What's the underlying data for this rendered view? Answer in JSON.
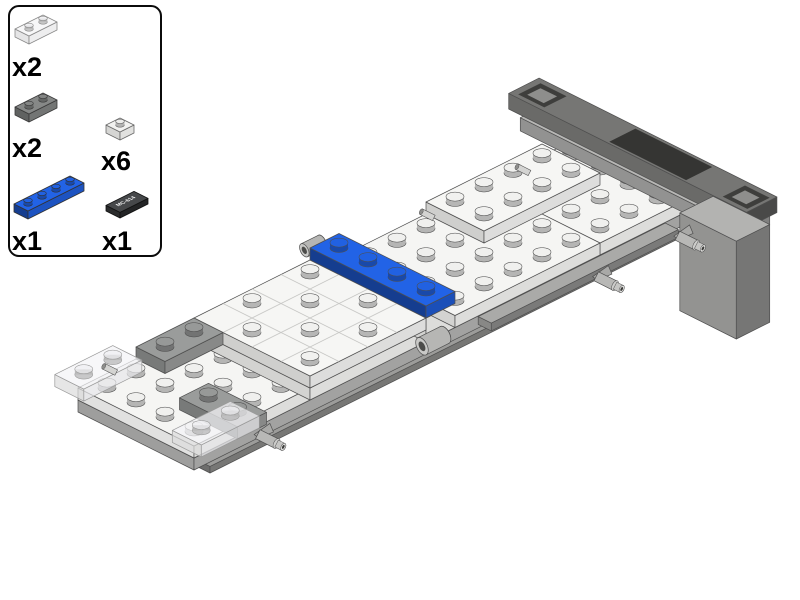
{
  "page": {
    "background": "#ffffff"
  },
  "parts_list": {
    "items": [
      {
        "part_name": "trans-clear plate 1x2",
        "count_label": "x2"
      },
      {
        "part_name": "dark gray plate 1x2",
        "count_label": "x2"
      },
      {
        "part_name": "white plate 1x1",
        "count_label": "x6"
      },
      {
        "part_name": "blue plate 1x4",
        "count_label": "x1"
      },
      {
        "part_name": "black license plate tile 1x2",
        "count_label": "x1",
        "print": "MC-614"
      }
    ]
  },
  "colors": {
    "white_plate": "#f5f5f3",
    "gray_base": "#c6c6c4",
    "medium_gray": "#9a9c9b",
    "dark_gray_bar": "#767674",
    "blue": "#2263e6",
    "trans_clear": "#f4f4f6",
    "black_tile": "#46484a",
    "outline": "#4f4f4f"
  },
  "render": {
    "groups": [
      {
        "name": "chassis-assembly",
        "proj": {
          "ox": 78,
          "oy": 400,
          "kx": 29,
          "ky": 14.5,
          "ph": 12,
          "line": "#4f4f4f",
          "lw": 0.7
        },
        "items": [
          {
            "t": "box",
            "name": "under-shadow",
            "u0": 0.4,
            "v0": 0.3,
            "u1": 16.6,
            "v1": 4.15,
            "h0": -1.55,
            "h1": -1,
            "c": "#9c9c9a",
            "fl": 0.7,
            "fr": 0.76
          },
          {
            "t": "box",
            "name": "gray-base-plate",
            "u0": 0,
            "v0": 0,
            "u1": 17,
            "v1": 4,
            "h0": -1,
            "h1": 0,
            "c": "#c6c6c4",
            "fl": 0.8,
            "fr": 0.82
          },
          {
            "t": "box",
            "name": "rear-white-plate",
            "u0": 14,
            "v0": 0,
            "u1": 17,
            "v1": 4,
            "h0": 0,
            "h1": 1,
            "c": "#f5f5f3",
            "fl": 0.86,
            "fr": 0.9,
            "studs": [
              [
                0.5,
                0.5
              ],
              [
                0.5,
                1.5
              ],
              [
                0.5,
                2.5
              ],
              [
                0.5,
                3.5
              ],
              [
                1.5,
                0.5
              ],
              [
                1.5,
                1.5
              ],
              [
                1.5,
                2.5
              ],
              [
                1.5,
                3.5
              ],
              [
                2.5,
                0.5
              ],
              [
                2.5,
                1.5
              ],
              [
                2.5,
                2.5
              ],
              [
                2.5,
                3.5
              ]
            ]
          },
          {
            "t": "box",
            "name": "bumper-under-beam",
            "u0": 16.45,
            "v0": -1.2,
            "u1": 17.5,
            "v1": 6.35,
            "h0": 1.1,
            "h1": 2.2,
            "c": "#b7b7b5",
            "fl": 0.8,
            "fr": 0.7
          },
          {
            "t": "box",
            "name": "rear-bumper-bar",
            "u0": 16.55,
            "v0": -1.7,
            "u1": 17.6,
            "v1": 6.5,
            "h0": 2.2,
            "h1": 3.5,
            "c": "#767674",
            "fl": 0.9,
            "fr": 0.62,
            "patches": [
              {
                "u0": 16.62,
                "v0": 1.7,
                "u1": 17.52,
                "v1": 4.35,
                "c": "#353533"
              },
              {
                "u0": 16.68,
                "v0": -1.5,
                "u1": 17.45,
                "v1": -0.6,
                "c": "#3e3e3c"
              },
              {
                "u0": 16.82,
                "v0": -1.33,
                "u1": 17.28,
                "v1": -0.76,
                "c": "#8e8e8c"
              },
              {
                "u0": 16.68,
                "v0": 5.55,
                "u1": 17.45,
                "v1": 6.4,
                "c": "#3e3e3c"
              },
              {
                "u0": 16.82,
                "v0": 5.72,
                "u1": 17.28,
                "v1": 6.22,
                "c": "#8e8e8c"
              }
            ]
          },
          {
            "t": "box",
            "name": "bumper-support-block",
            "u0": 16.35,
            "v0": 4.4,
            "u1": 17.5,
            "v1": 6.35,
            "h0": -7,
            "h1": 1.15,
            "c": "#b3b3b1",
            "fl": 0.82,
            "fr": 0.66
          },
          {
            "t": "box",
            "name": "side-rail-beam",
            "u0": 9.9,
            "v0": 3.9,
            "u1": 16.35,
            "v1": 4.35,
            "h0": -0.95,
            "h1": -0.3,
            "c": "#aaaaa8",
            "fl": 0.8,
            "fr": 0.72
          },
          {
            "t": "box",
            "name": "front-white-plate",
            "u0": 0,
            "v0": 0,
            "u1": 4,
            "v1": 4,
            "h0": 0,
            "h1": 1,
            "c": "#f5f5f3",
            "fl": 0.92,
            "fr": 0.9,
            "studs": [
              [
                0.5,
                0.5
              ],
              [
                0.5,
                1.5
              ],
              [
                0.5,
                2.5
              ],
              [
                0.5,
                3.5
              ],
              [
                1.5,
                0.5
              ],
              [
                1.5,
                1.5
              ],
              [
                1.5,
                2.5
              ],
              [
                1.5,
                3.5
              ],
              [
                2.5,
                0.5
              ],
              [
                2.5,
                1.5
              ],
              [
                2.5,
                2.5
              ],
              [
                2.5,
                3.5
              ],
              [
                3.5,
                0.5
              ],
              [
                3.5,
                1.5
              ],
              [
                3.5,
                2.5
              ],
              [
                3.5,
                3.5
              ]
            ]
          },
          {
            "t": "box",
            "name": "center-white-plate",
            "u0": 4,
            "v0": 0,
            "u1": 8,
            "v1": 4,
            "h0": 0,
            "h1": 1,
            "c": "#f5f5f3",
            "fl": 0.86,
            "fr": 0.9
          },
          {
            "t": "box",
            "name": "blue-under-plate",
            "u0": 8,
            "v0": 0,
            "u1": 9,
            "v1": 4,
            "h0": 0,
            "h1": 2,
            "c": "#f5f5f3",
            "fl": 0.86,
            "fr": 0.9
          },
          {
            "t": "box",
            "name": "mid-white-plate",
            "u0": 9,
            "v0": 0,
            "u1": 14,
            "v1": 4,
            "h0": 0,
            "h1": 1,
            "c": "#f5f5f3",
            "fl": 0.86,
            "fr": 0.9,
            "studs": [
              [
                0.5,
                0.5
              ],
              [
                0.5,
                1.5
              ],
              [
                0.5,
                2.5
              ],
              [
                0.5,
                3.5
              ],
              [
                1.5,
                0.5
              ],
              [
                1.5,
                1.5
              ],
              [
                1.5,
                2.5
              ],
              [
                1.5,
                3.5
              ],
              [
                2.5,
                0.5
              ],
              [
                2.5,
                1.5
              ],
              [
                2.5,
                2.5
              ],
              [
                2.5,
                3.5
              ],
              [
                3.5,
                2.5
              ],
              [
                3.5,
                3.5
              ],
              [
                4.5,
                2.5
              ],
              [
                4.5,
                3.5
              ]
            ]
          },
          {
            "t": "box",
            "name": "center-platform-4x4",
            "u0": 4,
            "v0": 0,
            "u1": 8,
            "v1": 4,
            "h0": 1,
            "h1": 2,
            "c": "#f6f6f4",
            "fl": 0.84,
            "fr": 0.9,
            "grid": true,
            "studs": [
              [
                0.5,
                1.5
              ],
              [
                1.5,
                0.5
              ],
              [
                2.5,
                1.5
              ],
              [
                3.5,
                0.5
              ],
              [
                1.5,
                2.5
              ],
              [
                0.5,
                3.5
              ],
              [
                2.5,
                3.5
              ],
              [
                3.5,
                2.5
              ]
            ]
          },
          {
            "t": "box",
            "name": "gray-plate-1x2-left",
            "u0": 2,
            "v0": 0,
            "u1": 4,
            "v1": 1,
            "h0": 1,
            "h1": 2,
            "c": "#9a9c9b",
            "fl": 0.78,
            "fr": 0.88,
            "studs": [
              [
                0.5,
                0.5
              ],
              [
                1.5,
                0.5
              ]
            ]
          },
          {
            "t": "box",
            "name": "gray-plate-1x2-front",
            "u0": 1,
            "v0": 2.5,
            "u1": 2,
            "v1": 4.5,
            "h0": 1,
            "h1": 2,
            "c": "#9a9c9b",
            "fl": 0.78,
            "fr": 0.88,
            "studs": [
              [
                0.5,
                0.5
              ],
              [
                0.5,
                1.5
              ]
            ]
          },
          {
            "t": "roller",
            "name": "hinge-cylinder-left",
            "u": 8.45,
            "v": -0.35,
            "h": 2.2,
            "s": 0.8
          },
          {
            "t": "box",
            "name": "blue-plate-1x4",
            "u0": 8,
            "v0": 0,
            "u1": 9,
            "v1": 4,
            "h0": 2,
            "h1": 3,
            "c": "#2263e6",
            "fl": 0.62,
            "fr": 0.8,
            "studs": [
              [
                0.5,
                0.5
              ],
              [
                0.5,
                1.5
              ],
              [
                0.5,
                2.5
              ],
              [
                0.5,
                3.5
              ]
            ]
          },
          {
            "t": "roller",
            "name": "hinge-cylinder-right",
            "u": 7.55,
            "v": 4.7,
            "h": 1.5,
            "s": 1.05
          },
          {
            "t": "box",
            "name": "raised-white-plate-2x4",
            "u0": 12,
            "v0": 0,
            "u1": 16,
            "v1": 2,
            "h0": 1,
            "h1": 2,
            "c": "#f6f6f4",
            "fl": 0.84,
            "fr": 0.9,
            "studs": [
              [
                0.5,
                0.5
              ],
              [
                0.5,
                1.5
              ],
              [
                1.5,
                0.5
              ],
              [
                1.5,
                1.5
              ],
              [
                2.5,
                0.5
              ],
              [
                2.5,
                1.5
              ],
              [
                3.5,
                0.5
              ],
              [
                3.5,
                1.5
              ]
            ]
          },
          {
            "t": "box",
            "name": "trans-clear-plate-front-left",
            "u0": -0.35,
            "v0": -0.45,
            "u1": 1.65,
            "v1": 0.55,
            "h0": 1,
            "h1": 2,
            "c": "#f4f4f6",
            "op": 0.72,
            "line": "#9a9a9a",
            "fl": 0.9,
            "fr": 0.95,
            "studs": [
              [
                0.5,
                0.5
              ],
              [
                1.5,
                0.5
              ]
            ]
          },
          {
            "t": "box",
            "name": "trans-clear-plate-front-right",
            "u0": -0.25,
            "v0": 3.5,
            "u1": 1.75,
            "v1": 4.5,
            "h0": 1,
            "h1": 2,
            "c": "#f4f4f6",
            "op": 0.72,
            "line": "#9a9a9a",
            "fl": 0.9,
            "fr": 0.95,
            "studs": [
              [
                0.5,
                0.5
              ],
              [
                1.5,
                0.5
              ]
            ]
          },
          {
            "t": "pin",
            "name": "towball-pin-front",
            "u": 2.15,
            "v": 4.05,
            "h": -0.55
          },
          {
            "t": "pin",
            "name": "towball-pin-mid",
            "u": 13.45,
            "v": 4.42,
            "h": -0.6
          },
          {
            "t": "pin",
            "name": "towball-pin-rear",
            "u": 16.25,
            "v": 4.42,
            "h": -0.6
          },
          {
            "t": "sbar",
            "name": "white-bar-front",
            "u": 1.15,
            "v": 0.2,
            "h": 1.1
          },
          {
            "t": "sbar",
            "name": "white-bar-mid",
            "u": 11.75,
            "v": 0.55,
            "h": 1.6
          },
          {
            "t": "sbar",
            "name": "white-bar-rear",
            "u": 14.95,
            "v": 0.65,
            "h": 1.6
          }
        ]
      },
      {
        "name": "icon-trans-clear-plate-1x2",
        "proj": {
          "ox": 15,
          "oy": 37,
          "kx": 14,
          "ky": 7,
          "ph": 8,
          "line": "#8a8a8a",
          "lw": 0.8
        },
        "items": [
          {
            "t": "box",
            "name": "part-shape",
            "u0": 0,
            "v0": 0,
            "u1": 2,
            "v1": 1,
            "h0": 0,
            "h1": 1,
            "c": "#f4f4f6",
            "op": 0.75,
            "fl": 0.9,
            "fr": 0.95,
            "studs": [
              [
                0.5,
                0.5
              ],
              [
                1.5,
                0.5
              ]
            ]
          }
        ]
      },
      {
        "name": "icon-dark-gray-plate-1x2",
        "proj": {
          "ox": 15,
          "oy": 115,
          "kx": 14,
          "ky": 7,
          "ph": 8,
          "line": "#3a3a3a",
          "lw": 0.8
        },
        "items": [
          {
            "t": "box",
            "name": "part-shape",
            "u0": 0,
            "v0": 0,
            "u1": 2,
            "v1": 1,
            "h0": 0,
            "h1": 1,
            "c": "#868887",
            "fl": 0.72,
            "fr": 0.86,
            "studs": [
              [
                0.5,
                0.5
              ],
              [
                1.5,
                0.5
              ]
            ]
          }
        ]
      },
      {
        "name": "icon-white-plate-1x1",
        "proj": {
          "ox": 106,
          "oy": 133,
          "kx": 14,
          "ky": 7,
          "ph": 8,
          "line": "#6a6a6a",
          "lw": 0.8
        },
        "items": [
          {
            "t": "box",
            "name": "part-shape",
            "u0": 0,
            "v0": 0,
            "u1": 1,
            "v1": 1,
            "h0": 0,
            "h1": 1,
            "c": "#f2f2f0",
            "fl": 0.88,
            "fr": 0.93,
            "studs": [
              [
                0.5,
                0.5
              ]
            ]
          }
        ]
      },
      {
        "name": "icon-blue-plate-1x4",
        "proj": {
          "ox": 14,
          "oy": 212,
          "kx": 14,
          "ky": 7,
          "ph": 8,
          "line": "#333333",
          "lw": 0.8
        },
        "items": [
          {
            "t": "box",
            "name": "part-shape",
            "u0": 0,
            "v0": 0,
            "u1": 4,
            "v1": 1,
            "h0": 0,
            "h1": 1,
            "c": "#2263e6",
            "fl": 0.62,
            "fr": 0.84,
            "studs": [
              [
                0.5,
                0.5
              ],
              [
                1.5,
                0.5
              ],
              [
                2.5,
                0.5
              ],
              [
                3.5,
                0.5
              ]
            ]
          }
        ]
      },
      {
        "name": "icon-black-license-tile",
        "proj": {
          "ox": 106,
          "oy": 211,
          "kx": 14,
          "ky": 7,
          "ph": 8,
          "line": "#111111",
          "lw": 0.8
        },
        "items": [
          {
            "t": "box",
            "name": "part-shape",
            "u0": 0,
            "v0": 0,
            "u1": 2,
            "v1": 1,
            "h0": 0,
            "h1": 0.7,
            "c": "#46484a",
            "fl": 0.6,
            "fr": 0.5
          },
          {
            "t": "ttext",
            "name": "license-print",
            "u": 1,
            "v": 0.52,
            "h": 0.7,
            "text": "MC-614",
            "c": "#f2f2f2",
            "size": 5.5
          }
        ]
      }
    ]
  }
}
